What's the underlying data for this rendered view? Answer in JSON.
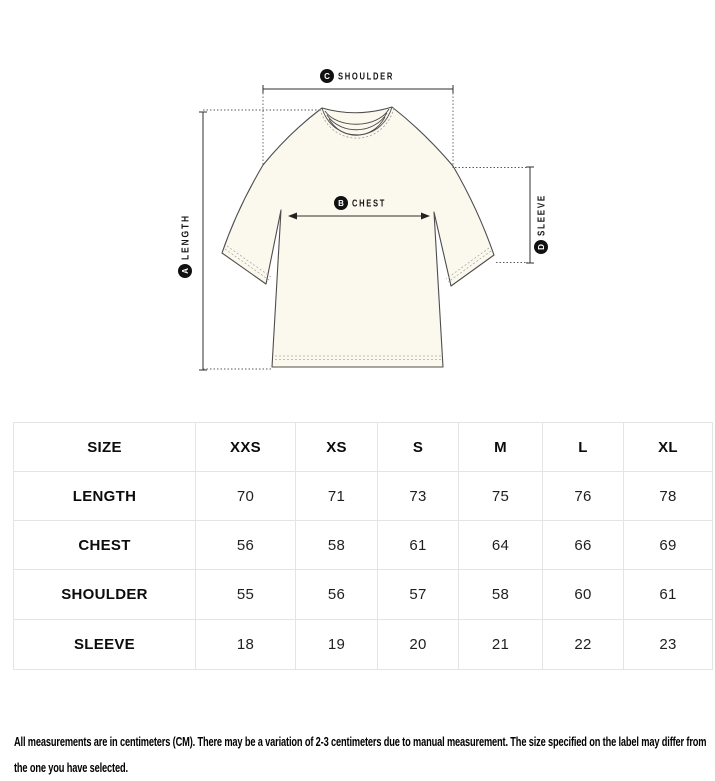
{
  "diagram": {
    "annotations": [
      {
        "letter": "A",
        "label": "LENGTH"
      },
      {
        "letter": "B",
        "label": "CHEST"
      },
      {
        "letter": "C",
        "label": "SHOULDER"
      },
      {
        "letter": "D",
        "label": "SLEEVE"
      }
    ],
    "colors": {
      "shirt_fill": "#FBF9EE",
      "outline": "#4d4d4d",
      "badge": "#111111"
    }
  },
  "size_table": {
    "columns": [
      "SIZE",
      "XXS",
      "XS",
      "S",
      "M",
      "L",
      "XL"
    ],
    "rows": [
      {
        "label": "LENGTH",
        "values": [
          "70",
          "71",
          "73",
          "75",
          "76",
          "78"
        ]
      },
      {
        "label": "CHEST",
        "values": [
          "56",
          "58",
          "61",
          "64",
          "66",
          "69"
        ]
      },
      {
        "label": "SHOULDER",
        "values": [
          "55",
          "56",
          "57",
          "58",
          "60",
          "61"
        ]
      },
      {
        "label": "SLEEVE",
        "values": [
          "18",
          "19",
          "20",
          "21",
          "22",
          "23"
        ]
      }
    ]
  },
  "footnote": "All measurements are in centimeters (CM). There may be a variation of 2-3 centimeters due to manual measurement. The size specified on the label may differ from the one you have selected."
}
